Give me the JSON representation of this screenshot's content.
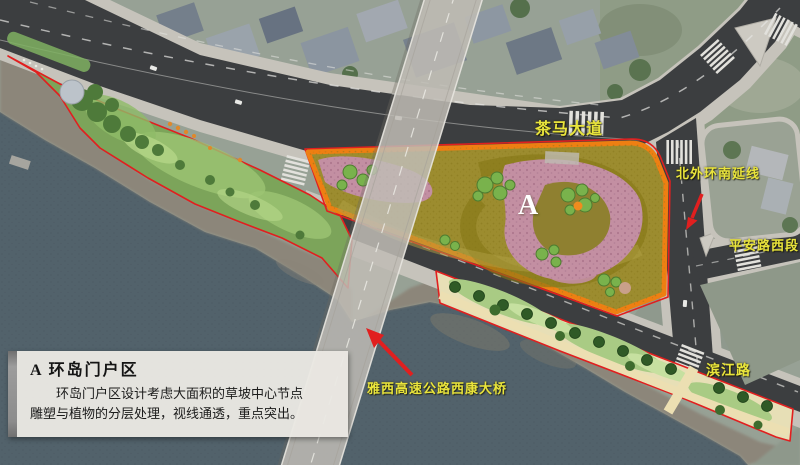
{
  "map": {
    "area_marker": "A",
    "labels": {
      "chama_avenue": "茶马大道",
      "north_ring_south_extension": "北外环南延线",
      "pingan_road_west": "平安路西段",
      "binjiang_road": "滨江路",
      "expressway_bridge": "雅西高速公路西康大桥"
    }
  },
  "info_box": {
    "title": "A 环岛门户区",
    "body_line1": "环岛门户区设计考虑大面积的草坡中心节点",
    "body_line2": "雕塑与植物的分层处理，视线通透，重点突出。"
  },
  "colors": {
    "label_yellow": "#e9e43c",
    "boundary_red": "#e11f1f",
    "area_border_orange": "#ee7f12",
    "water_teal": "#52626b",
    "road_dark": "#3c3e40",
    "sidewalk_concrete": "#c6c3bb",
    "grass_olive": "#9c8c2f",
    "planting_pink": "#c38fa2",
    "lawn_green": "#a9cb84",
    "bridge_gray": "#c0bcb5"
  }
}
